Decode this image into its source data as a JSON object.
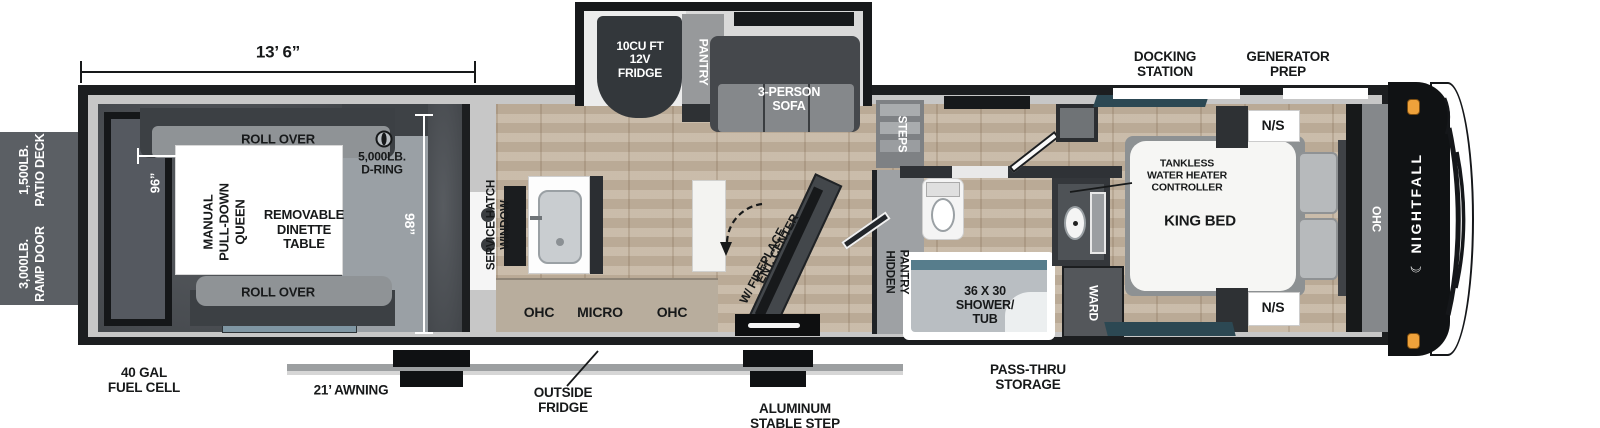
{
  "brand": {
    "name": "NIGHTFALL",
    "crescent_icon": "☾"
  },
  "dims": {
    "garage_length": "13’ 6”",
    "garage_width": "98”",
    "queen_width": "96”"
  },
  "exterior": {
    "patio_deck": [
      "1,500LB.",
      "PATIO DECK"
    ],
    "ramp_door": [
      "3,000LB.",
      "RAMP DOOR"
    ],
    "fuel_cell": [
      "40 GAL",
      "FUEL CELL"
    ],
    "awning": "21’ AWNING",
    "outside_fridge": [
      "OUTSIDE",
      "FRIDGE"
    ],
    "stable_step": [
      "ALUMINUM",
      "STABLE STEP"
    ],
    "pass_thru_storage": [
      "PASS-THRU",
      "STORAGE"
    ],
    "docking_station": [
      "DOCKING",
      "STATION"
    ],
    "generator_prep": [
      "GENERATOR",
      "PREP"
    ]
  },
  "garage": {
    "roll_over_top": "ROLL OVER",
    "roll_over_bottom": "ROLL OVER",
    "queen_bed": [
      "MANUAL",
      "PULL-DOWN",
      "QUEEN"
    ],
    "dinette": [
      "REMOVABLE",
      "DINETTE",
      "TABLE"
    ],
    "d_ring": [
      "5,000LB.",
      "D-RING"
    ]
  },
  "kitchen": {
    "service_hatch": [
      "SERVICE HATCH",
      "WINDOW"
    ],
    "ohc_left": "OHC",
    "micro": "MICRO",
    "ohc_right": "OHC"
  },
  "living": {
    "fridge": [
      "10CU FT",
      "12V",
      "FRIDGE"
    ],
    "pantry": "PANTRY",
    "sofa": [
      "3-PERSON",
      "SOFA"
    ],
    "ent_center": [
      "ENT. CENTER",
      "W/ FIREPLACE"
    ],
    "steps": "STEPS",
    "hidden_pantry": [
      "HIDDEN",
      "PANTRY"
    ]
  },
  "bathroom": {
    "shower_tub": [
      "36 X 30",
      "SHOWER/",
      "TUB"
    ],
    "wardrobe": "WARD"
  },
  "bedroom": {
    "king_bed": "KING BED",
    "nightstand_top": "N/S",
    "nightstand_bottom": "N/S",
    "tankless": [
      "TANKLESS",
      "WATER HEATER",
      "CONTROLLER"
    ],
    "ohc": "OHC"
  },
  "colors": {
    "wood_floor": "#c4b5a1",
    "garage_floor": "#4b4f54",
    "ramp_panel": "#5b5f64",
    "wall_gray": "#c7c7c7",
    "line_black": "#17191a",
    "window_teal": "#2c4853",
    "marker_light": "#efa23b"
  }
}
